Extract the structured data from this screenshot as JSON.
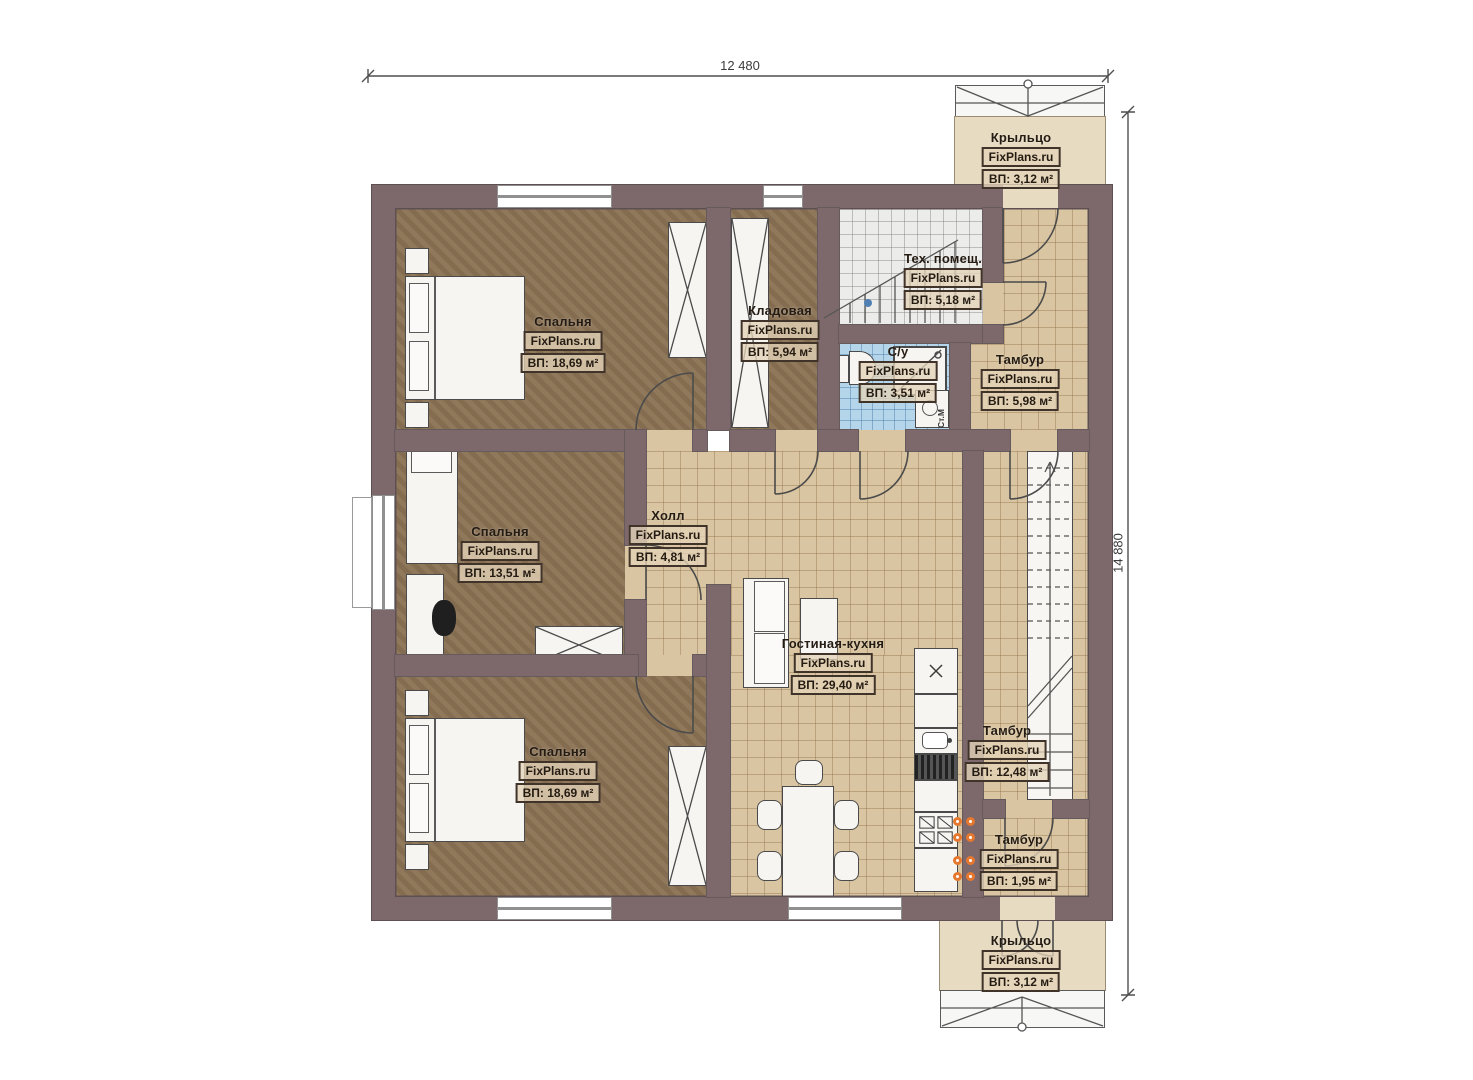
{
  "meta": {
    "watermark": "FixPlans.ru"
  },
  "dimensions": {
    "top": "12 480",
    "right": "14 880"
  },
  "rooms": [
    {
      "id": "bedroom-top",
      "name": "Спальня",
      "area": "ВП: 18,69 м²"
    },
    {
      "id": "storage",
      "name": "Кладовая",
      "area": "ВП: 5,94 м²"
    },
    {
      "id": "tech-room",
      "name": "Тех. помещ.",
      "area": "ВП: 5,18 м²"
    },
    {
      "id": "bathroom",
      "name": "С/у",
      "area": "ВП: 3,51 м²"
    },
    {
      "id": "tambour-top",
      "name": "Тамбур",
      "area": "ВП: 5,98 м²"
    },
    {
      "id": "hall",
      "name": "Холл",
      "area": "ВП: 4,81 м²"
    },
    {
      "id": "bedroom-mid",
      "name": "Спальня",
      "area": "ВП: 13,51 м²"
    },
    {
      "id": "living-kitchen",
      "name": "Гостиная-кухня",
      "area": "ВП: 29,40 м²"
    },
    {
      "id": "bedroom-bottom",
      "name": "Спальня",
      "area": "ВП: 18,69 м²"
    },
    {
      "id": "tambour-mid",
      "name": "Тамбур",
      "area": "ВП: 12,48 м²"
    },
    {
      "id": "tambour-bottom",
      "name": "Тамбур",
      "area": "ВП: 1,95 м²"
    },
    {
      "id": "porch-top",
      "name": "Крыльцо",
      "area": "ВП: 3,12 м²"
    },
    {
      "id": "porch-bottom",
      "name": "Крыльцо",
      "area": "ВП: 3,12 м²"
    }
  ],
  "appliances": {
    "washing_machine": "Ст.М"
  },
  "colors": {
    "wall": "#7d696b",
    "bedroom_floor": "#8b7254",
    "tile_beige": "#d9c5a1",
    "tile_blue": "#b4d5ea",
    "tile_white": "#ececea",
    "porch": "#e7dbc1",
    "accent_orange": "#e6772e"
  }
}
